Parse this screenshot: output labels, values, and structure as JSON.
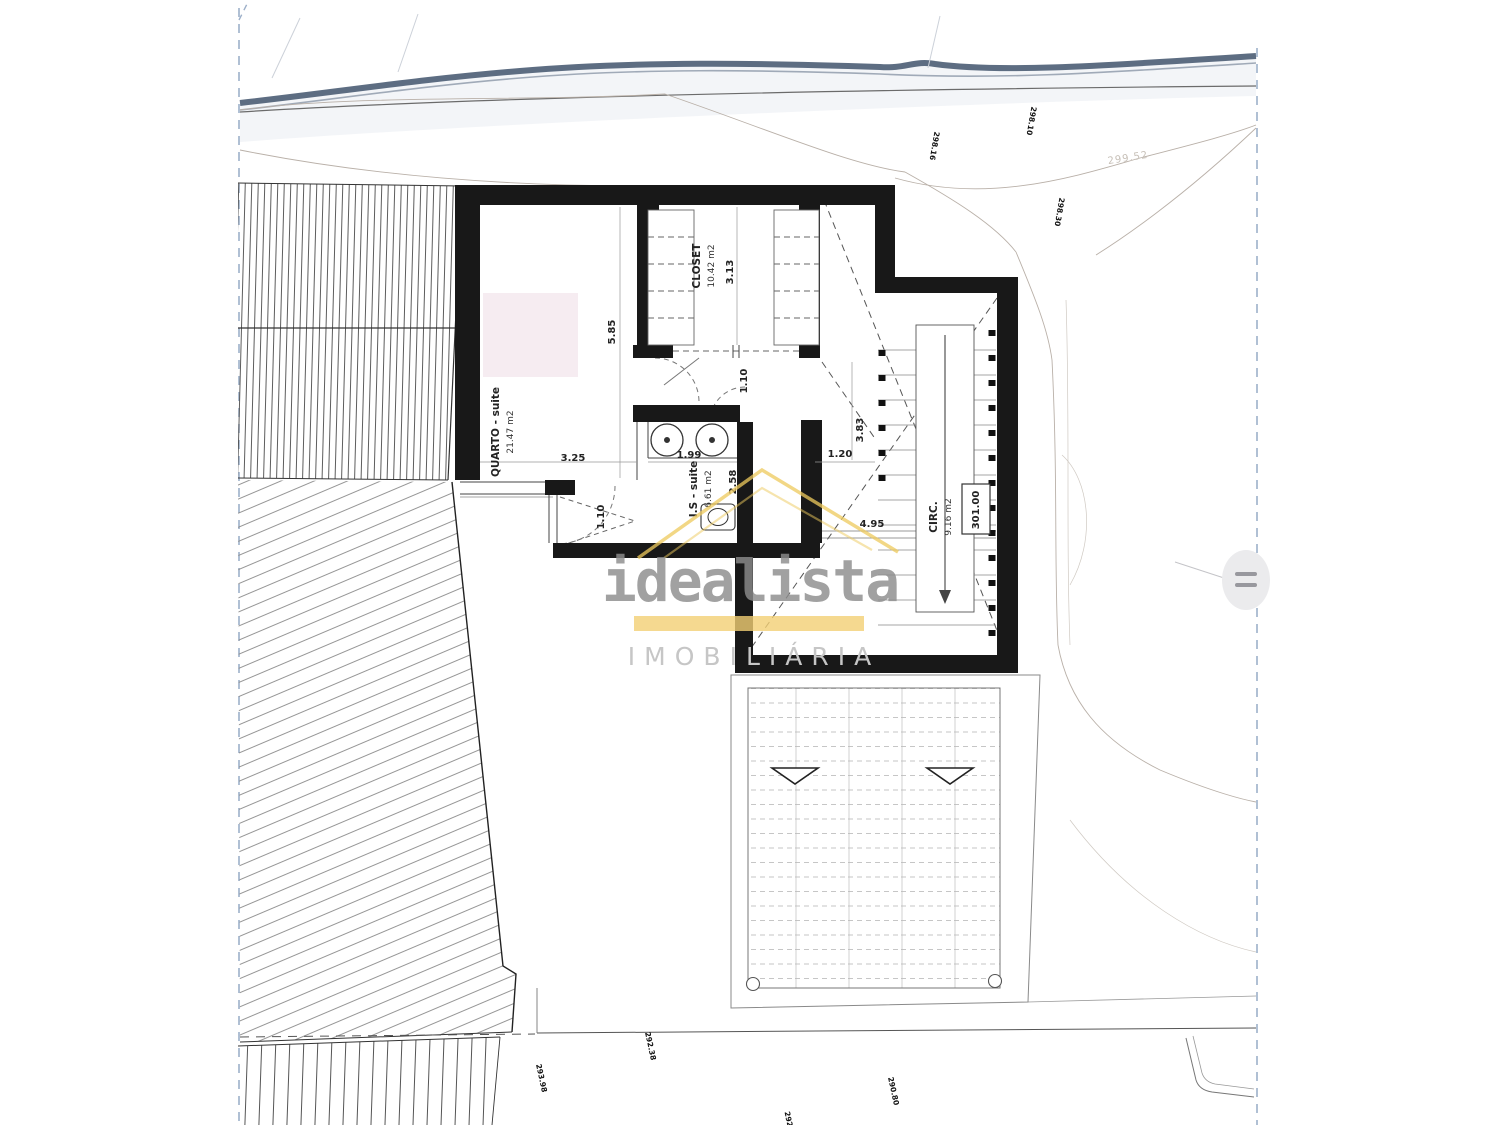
{
  "page": {
    "background": "#ffffff",
    "scan_border_color": "#9db0c9",
    "topo_edge_color": "#5d6d82",
    "wall_color": "#181818"
  },
  "watermark": {
    "brand": "idealista",
    "subtitle": "IMOBILIÁRIA",
    "house_color": "#eec95c",
    "underline_color": "#f2d074",
    "brand_color": "#8d8d8d",
    "subtitle_color": "#c6c6c6",
    "menu_icon": "hamburger-icon"
  },
  "rooms": {
    "quarto": {
      "name": "QUARTO - suite",
      "area": "21.47 m2"
    },
    "closet": {
      "name": "CLOSET",
      "area": "10.42 m2"
    },
    "is_suite": {
      "name": "I.S - suite",
      "area": "6.61 m2"
    },
    "circ": {
      "name": "CIRC.",
      "area": "9.16 m2"
    }
  },
  "level": {
    "value": "301.00"
  },
  "dims": {
    "quarto_h": "5.85",
    "quarto_w": "3.25",
    "closet_h": "3.13",
    "closet_door": "1.10",
    "vanity": "1.99",
    "is_w": "2.58",
    "hall_gap": "1.20",
    "hall_h": "3.83",
    "window": "1.10",
    "circ_l": "4.95"
  },
  "site_labels": {
    "contour": "299.52",
    "e1": "298.16",
    "e2": "298.10",
    "e3": "298.30",
    "e4": "292.38",
    "e5": "293.98",
    "e6": "290.80",
    "e7": "292"
  }
}
